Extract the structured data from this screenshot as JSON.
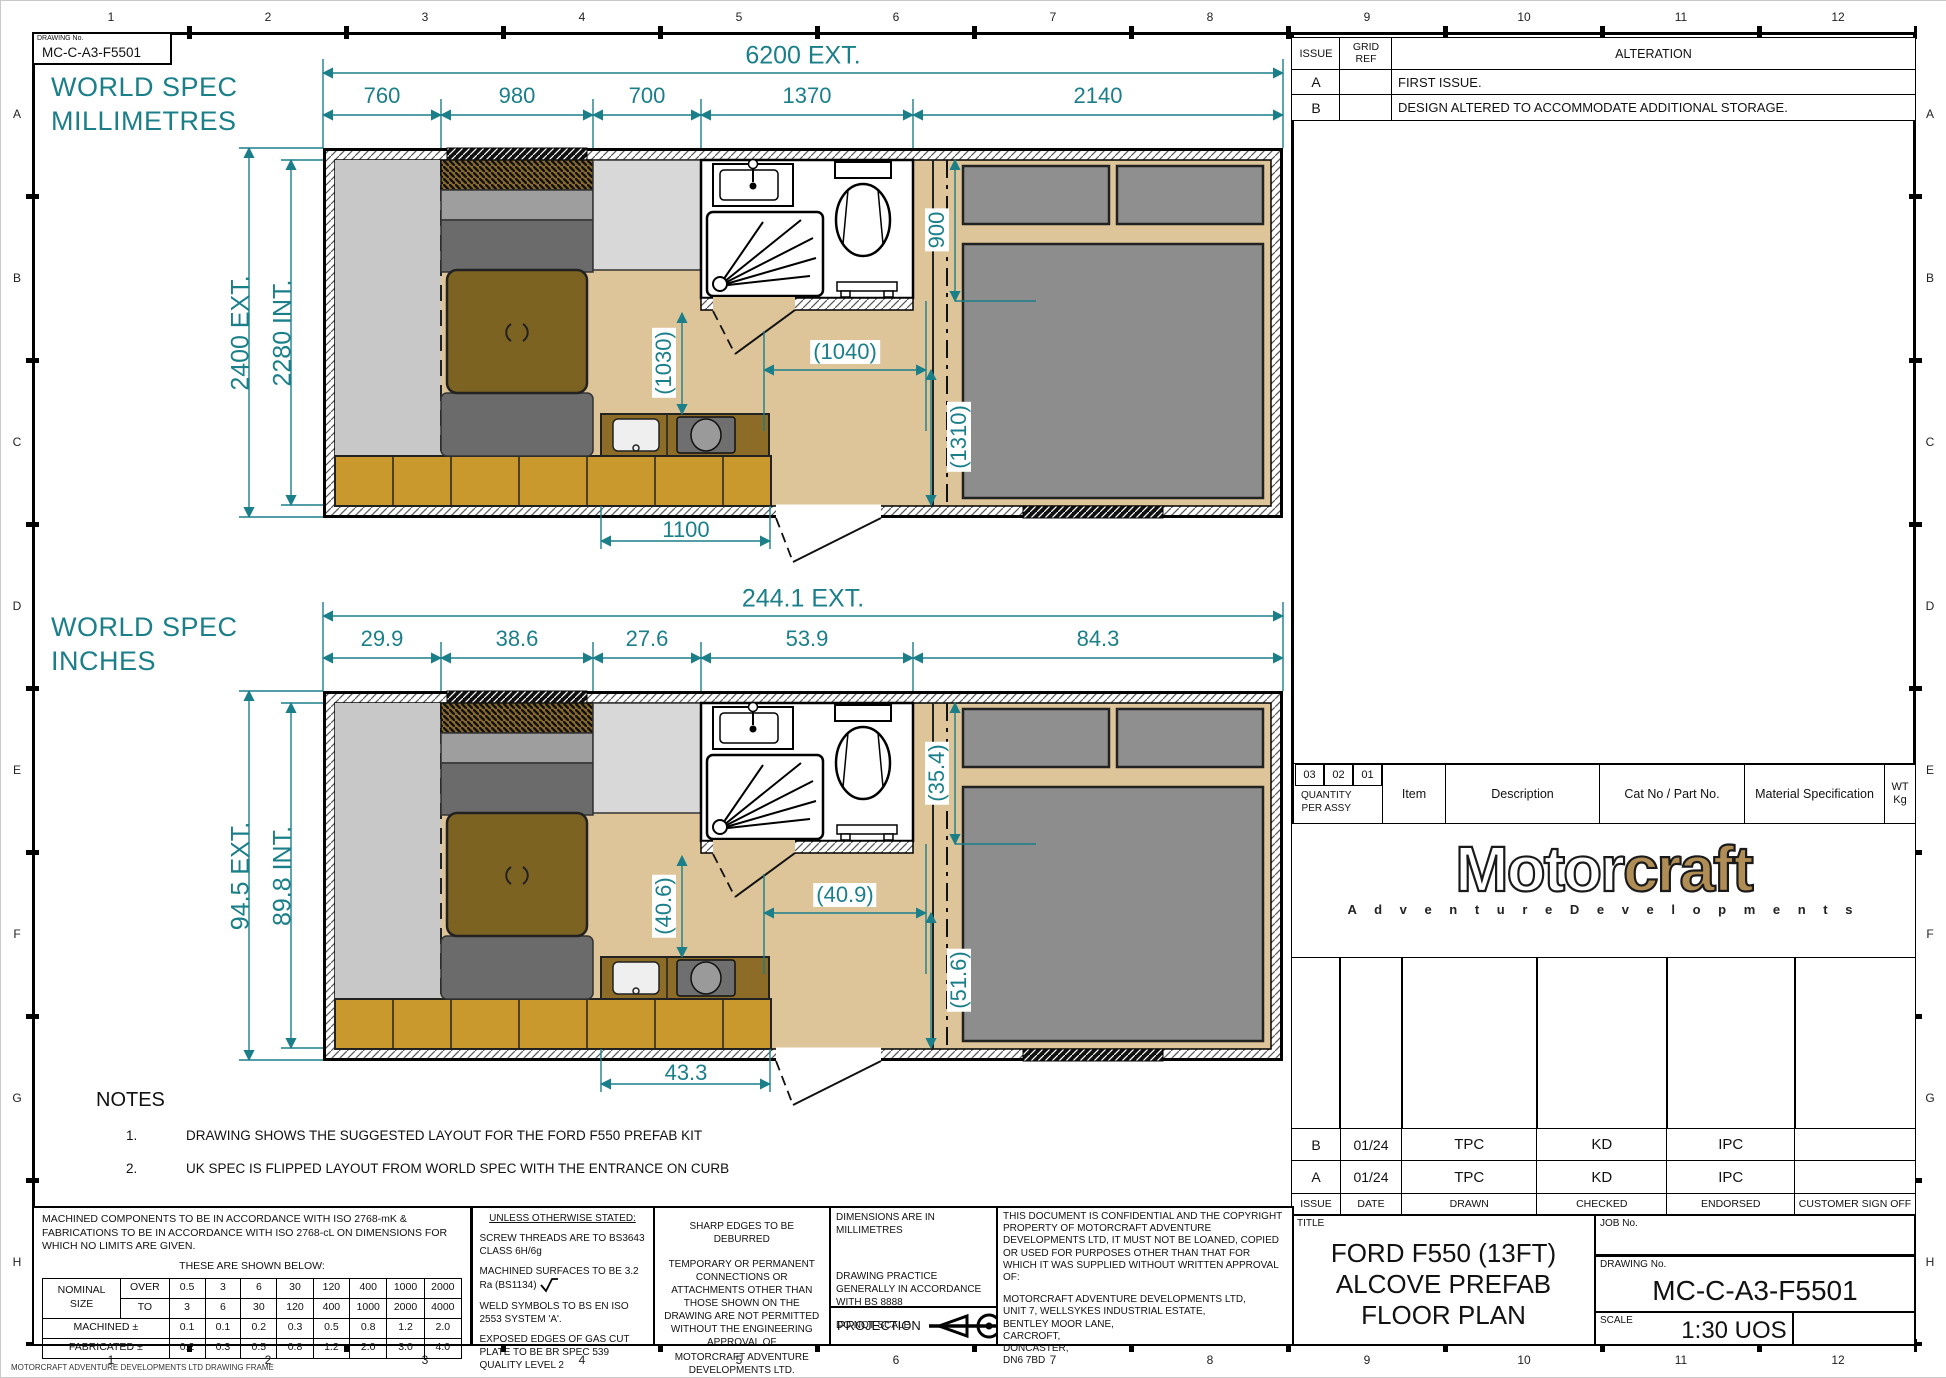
{
  "frame": {
    "drawing_no_label": "DRAWING No.",
    "drawing_no": "MC-C-A3-F5501",
    "columns": [
      "1",
      "2",
      "3",
      "4",
      "5",
      "6",
      "7",
      "8",
      "9",
      "10",
      "11",
      "12"
    ],
    "rows": [
      "A",
      "B",
      "C",
      "D",
      "E",
      "F",
      "G",
      "H"
    ],
    "footer_note": "MOTORCRAFT ADVENTURE DEVELOPMENTS LTD DRAWING FRAME"
  },
  "colors": {
    "dimension_teal": "#1b7f8a",
    "floor_tan": "#ddc499",
    "cabinet_gold": "#c9992e",
    "counter_brown": "#8c6c26",
    "table_brown": "#7c6322",
    "logo_tan": "#b08d55"
  },
  "alteration_table": {
    "issue_header": "ISSUE",
    "grid_ref_header": "GRID\nREF",
    "alteration_header": "ALTERATION",
    "rows": [
      {
        "issue": "A",
        "grid_ref": "",
        "alteration": "FIRST ISSUE."
      },
      {
        "issue": "B",
        "grid_ref": "",
        "alteration": "DESIGN ALTERED TO ACCOMMODATE ADDITIONAL STORAGE."
      }
    ]
  },
  "plans": [
    {
      "spec_title": "WORLD SPEC",
      "spec_sub": "MILLIMETRES",
      "overall": "6200  EXT.",
      "segments": [
        "760",
        "980",
        "700",
        "1370",
        "2140"
      ],
      "ext_height": "2400  EXT.",
      "int_height": "2280  INT.",
      "inner_v1": "(1030)",
      "inner_h": "(1040)",
      "inner_v2": "(1310)",
      "right_v": "900",
      "bottom": "1100"
    },
    {
      "spec_title": "WORLD SPEC",
      "spec_sub": "INCHES",
      "overall": "244.1  EXT.",
      "segments": [
        "29.9",
        "38.6",
        "27.6",
        "53.9",
        "84.3"
      ],
      "ext_height": "94.5  EXT.",
      "int_height": "89.8  INT.",
      "inner_v1": "(40.6)",
      "inner_h": "(40.9)",
      "inner_v2": "(51.6)",
      "right_v": "(35.4)",
      "bottom": "43.3"
    }
  ],
  "notes": {
    "title": "NOTES",
    "items": [
      {
        "num": "1.",
        "text": "DRAWING SHOWS THE SUGGESTED LAYOUT FOR THE FORD F550 PREFAB KIT"
      },
      {
        "num": "2.",
        "text": "UK SPEC IS FLIPPED LAYOUT FROM WORLD SPEC WITH THE ENTRANCE ON CURB"
      }
    ]
  },
  "parts_table": {
    "qty_cols": [
      "03",
      "02",
      "01"
    ],
    "qty_label": "QUANTITY\nPER ASSY",
    "item": "Item",
    "description": "Description",
    "cat_no": "Cat No / Part No.",
    "material": "Material Specification",
    "wt": "WT\nKg"
  },
  "logo": {
    "motor": "Motor",
    "craft": "craft",
    "subtitle": "A d v e n t u r e   D e v e l o p m e n t s"
  },
  "issue_history": {
    "rows": [
      {
        "issue": "B",
        "date": "01/24",
        "drawn": "TPC",
        "checked": "KD",
        "endorsed": "IPC",
        "customer": ""
      },
      {
        "issue": "A",
        "date": "01/24",
        "drawn": "TPC",
        "checked": "KD",
        "endorsed": "IPC",
        "customer": ""
      }
    ],
    "headers": [
      "ISSUE",
      "DATE",
      "DRAWN",
      "CHECKED",
      "ENDORSED",
      "CUSTOMER SIGN OFF"
    ]
  },
  "title_block": {
    "title_label": "TITLE",
    "title_line1": "FORD F550 (13FT)",
    "title_line2": "ALCOVE PREFAB",
    "title_line3": "FLOOR PLAN",
    "job_label": "JOB No.",
    "job_value": "",
    "drawing_label": "DRAWING No.",
    "drawing_value": "MC-C-A3-F5501",
    "scale_label": "SCALE",
    "scale_value": "1:30 UOS"
  },
  "tolerance_panel": {
    "para": "MACHINED COMPONENTS TO BE IN ACCORDANCE WITH ISO 2768-mK & FABRICATIONS TO BE IN ACCORDANCE WITH ISO 2768-cL ON DIMENSIONS FOR WHICH NO LIMITS ARE GIVEN.",
    "subtitle": "THESE ARE SHOWN BELOW:",
    "nominal_label": "NOMINAL\nSIZE",
    "over_label": "OVER",
    "to_label": "TO",
    "machined_label": "MACHINED ±",
    "fabricated_label": "FABRICATED ±",
    "over": [
      "0.5",
      "3",
      "6",
      "30",
      "120",
      "400",
      "1000",
      "2000"
    ],
    "to": [
      "3",
      "6",
      "30",
      "120",
      "400",
      "1000",
      "2000",
      "4000"
    ],
    "machined": [
      "0.1",
      "0.1",
      "0.2",
      "0.3",
      "0.5",
      "0.8",
      "1.2",
      "2.0"
    ],
    "fabricated": [
      "0.2",
      "0.3",
      "0.5",
      "0.8",
      "1.2",
      "2.0",
      "3.0",
      "4.0"
    ]
  },
  "uos_panel": {
    "title": "UNLESS OTHERWISE STATED:",
    "item1": "SCREW THREADS ARE TO BS3643 CLASS 6H/6g",
    "item2": "MACHINED SURFACES TO BE 3.2  Ra (BS1134)",
    "item3": "WELD SYMBOLS TO BS EN ISO 2553 SYSTEM 'A'.",
    "item4": "EXPOSED EDGES OF GAS CUT PLATE TO BE BR SPEC 539 QUALITY LEVEL 2"
  },
  "edges_panel": {
    "line1": "SHARP EDGES TO BE DEBURRED",
    "line2": "TEMPORARY OR PERMANENT CONNECTIONS OR ATTACHMENTS OTHER THAN THOSE SHOWN ON THE DRAWING ARE NOT PERMITTED WITHOUT THE ENGINEERING APPROVAL OF",
    "line3": "MOTORCRAFT ADVENTURE DEVELOPMENTS LTD."
  },
  "dims_panel": {
    "line1": "DIMENSIONS ARE IN MILLIMETRES",
    "line2": "DRAWING PRACTICE GENERALLY IN ACCORDANCE WITH BS 8888",
    "line3": "DO NOT SCALE",
    "projection_label": "PROJECTION"
  },
  "confidential_panel": {
    "para": "THIS DOCUMENT IS CONFIDENTIAL AND THE COPYRIGHT PROPERTY OF MOTORCRAFT ADVENTURE DEVELOPMENTS LTD, IT MUST NOT BE LOANED, COPIED OR USED FOR PURPOSES OTHER THAN THAT FOR WHICH IT WAS SUPPLIED WITHOUT WRITTEN APPROVAL OF:",
    "addr1": "MOTORCRAFT ADVENTURE DEVELOPMENTS LTD,",
    "addr2": "UNIT 7, WELLSYKES INDUSTRIAL ESTATE,",
    "addr3": "BENTLEY MOOR LANE,",
    "addr4": "CARCROFT,",
    "addr5": "DONCASTER,",
    "addr6": "DN6 7BD"
  }
}
